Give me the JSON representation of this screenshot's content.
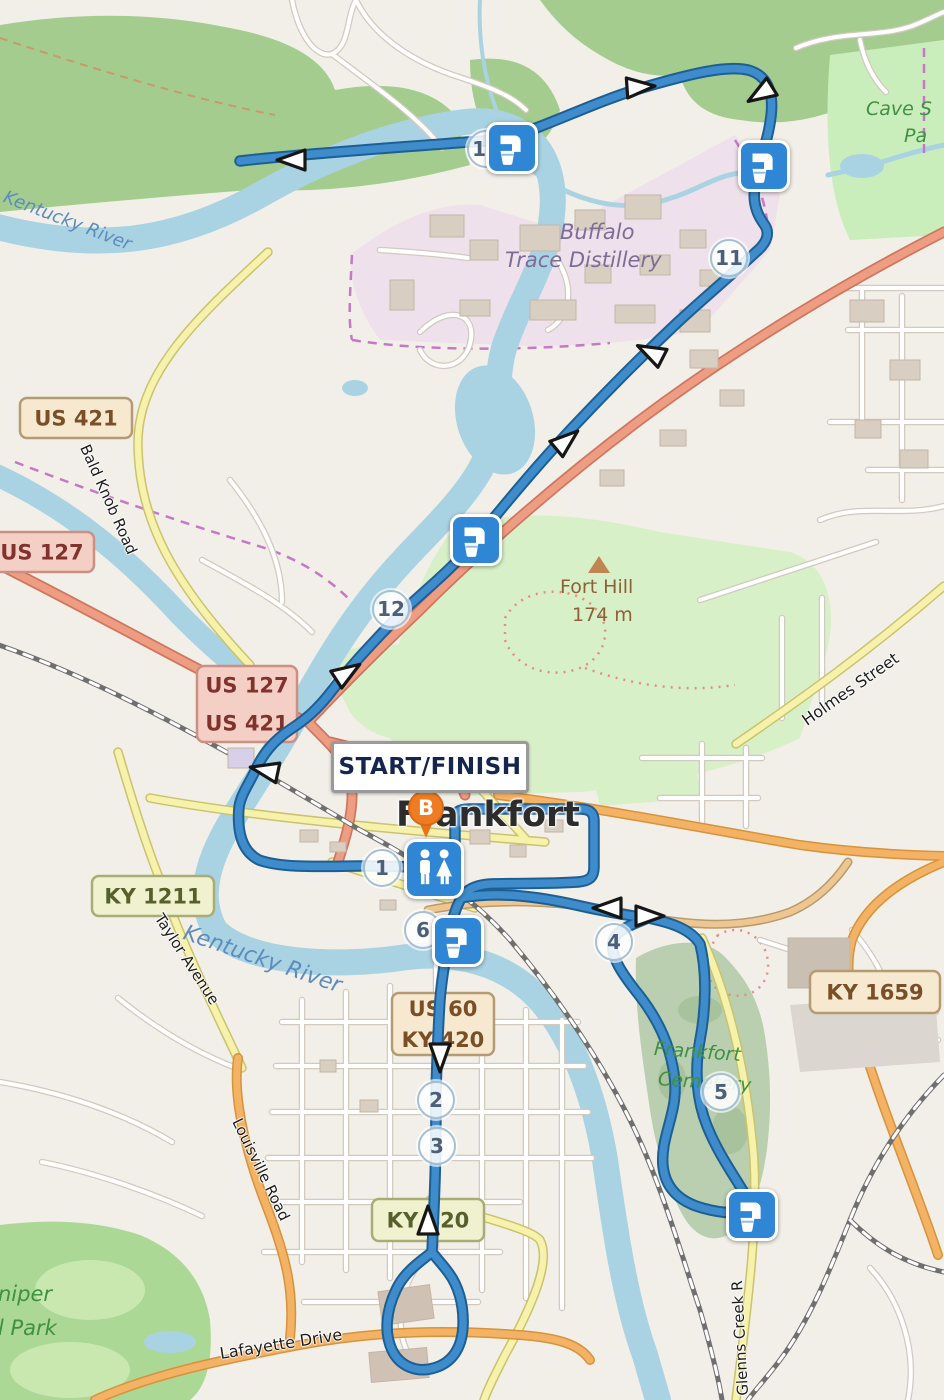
{
  "theme": {
    "route_blue": "#3e8ccb",
    "route_casing": "#1e5f93",
    "marker_blue": "#2e86d4",
    "marker_orange": "#ee7c23",
    "water": "#a9d3e3"
  },
  "map": {
    "labels": {
      "kr_top": "Kentucky River",
      "kr_downtown": "Kentucky River",
      "buffalo_1": "Buffalo",
      "buffalo_2": "Trace Distillery",
      "cave_1": "Cave S",
      "cave_2": "Pa",
      "fort_hill": "Fort Hill",
      "fort_hill_elev": "174 m",
      "frankfort": "Frankfort",
      "cemetery_1": "Frankfort",
      "cemetery_2": "Cemetery",
      "holmes": "Holmes Street",
      "bald_knob": "Bald Knob Road",
      "taylor": "Taylor Avenue",
      "louisville": "Louisville Road",
      "lafayette": "Lafayette Drive",
      "glenns": "Glenns Creek R",
      "juniper_1": "niper",
      "juniper_2": "l Park"
    },
    "start_finish": {
      "label": "START/FINISH"
    },
    "b_marker": {
      "label": "B"
    },
    "badges": [
      {
        "id": "us-421",
        "style": "cream",
        "x": 20,
        "y": 398,
        "w": 112,
        "h": 40,
        "lines": [
          "US 421"
        ]
      },
      {
        "id": "us-127",
        "style": "pink",
        "x": -10,
        "y": 532,
        "w": 104,
        "h": 40,
        "lines": [
          "US 127"
        ]
      },
      {
        "id": "us-127-421",
        "style": "pink",
        "x": 197,
        "y": 666,
        "w": 100,
        "h": 76,
        "lines": [
          "US 127",
          "US 421"
        ]
      },
      {
        "id": "ky-1211",
        "style": "olive",
        "x": 92,
        "y": 876,
        "w": 122,
        "h": 40,
        "lines": [
          "KY 1211"
        ]
      },
      {
        "id": "ky-1659",
        "style": "cream",
        "x": 810,
        "y": 971,
        "w": 130,
        "h": 42,
        "lines": [
          "KY 1659"
        ]
      },
      {
        "id": "us-60-ky-420",
        "style": "cream",
        "x": 392,
        "y": 993,
        "w": 102,
        "h": 62,
        "lines": [
          "US 60",
          "KY 420"
        ]
      },
      {
        "id": "ky-420",
        "style": "olive",
        "x": 372,
        "y": 1199,
        "w": 112,
        "h": 42,
        "lines": [
          "KY 420"
        ]
      }
    ],
    "mile_markers": [
      {
        "n": "1",
        "x": 382,
        "y": 868
      },
      {
        "n": "2",
        "x": 436,
        "y": 1100
      },
      {
        "n": "3",
        "x": 437,
        "y": 1146
      },
      {
        "n": "4",
        "x": 614,
        "y": 942
      },
      {
        "n": "5",
        "x": 721,
        "y": 1092
      },
      {
        "n": "6",
        "x": 423,
        "y": 930
      },
      {
        "n": "10",
        "x": 486,
        "y": 149
      },
      {
        "n": "11",
        "x": 729,
        "y": 258
      },
      {
        "n": "12",
        "x": 391,
        "y": 609
      }
    ],
    "water_stops": [
      {
        "x": 512,
        "y": 148
      },
      {
        "x": 764,
        "y": 166
      },
      {
        "x": 476,
        "y": 540
      },
      {
        "x": 458,
        "y": 941
      },
      {
        "x": 752,
        "y": 1215
      }
    ],
    "restroom": {
      "x": 434,
      "y": 869
    },
    "arrows": [
      {
        "x": 291,
        "y": 160,
        "deg": 180
      },
      {
        "x": 641,
        "y": 87,
        "deg": -4
      },
      {
        "x": 760,
        "y": 94,
        "deg": 148
      },
      {
        "x": 650,
        "y": 352,
        "deg": 207
      },
      {
        "x": 567,
        "y": 440,
        "deg": -40
      },
      {
        "x": 348,
        "y": 672,
        "deg": -33
      },
      {
        "x": 264,
        "y": 770,
        "deg": 192
      },
      {
        "x": 607,
        "y": 908,
        "deg": 180
      },
      {
        "x": 650,
        "y": 916,
        "deg": 0
      },
      {
        "x": 440,
        "y": 1058,
        "deg": 90
      },
      {
        "x": 428,
        "y": 1220,
        "deg": -90
      }
    ]
  }
}
